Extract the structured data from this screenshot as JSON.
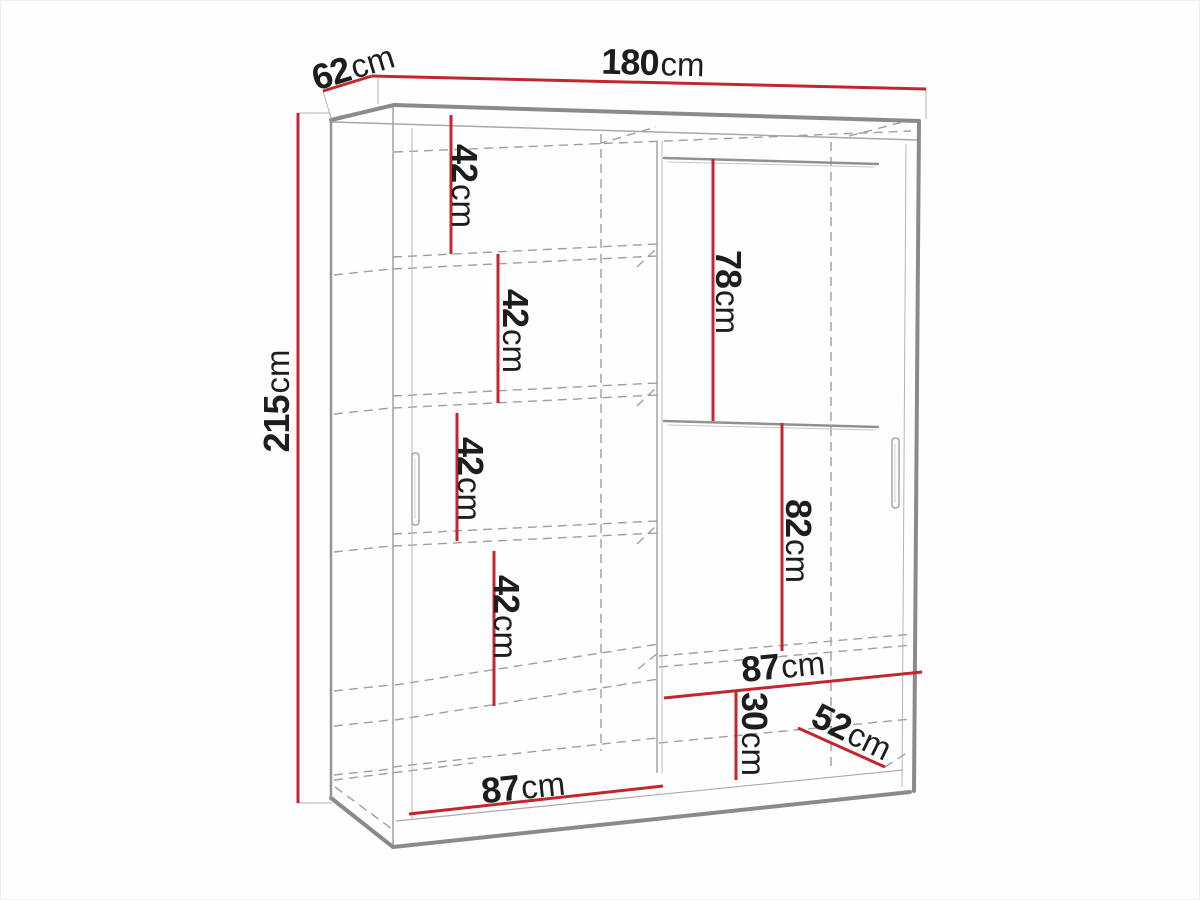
{
  "figure": {
    "subject": "Two-door sliding wardrobe dimension diagram",
    "view": "front perspective line drawing with see-through doors, shelves left, hanging rods right"
  },
  "colors": {
    "dimension_red": "#c2262e",
    "outline_gray": "#8a8a8a",
    "text": "#1d1d1b"
  },
  "dims": {
    "height": {
      "value": "215",
      "unit": "cm"
    },
    "depth": {
      "value": "62",
      "unit": "cm"
    },
    "width": {
      "value": "180",
      "unit": "cm"
    },
    "shelf_gap_1": {
      "value": "42",
      "unit": "cm"
    },
    "shelf_gap_2": {
      "value": "42",
      "unit": "cm"
    },
    "shelf_gap_3": {
      "value": "42",
      "unit": "cm"
    },
    "shelf_gap_4": {
      "value": "42",
      "unit": "cm"
    },
    "rod_gap_upper": {
      "value": "78",
      "unit": "cm"
    },
    "rod_gap_lower": {
      "value": "82",
      "unit": "cm"
    },
    "right_width": {
      "value": "87",
      "unit": "cm"
    },
    "bottom_gap": {
      "value": "30",
      "unit": "cm"
    },
    "bottom_depth": {
      "value": "52",
      "unit": "cm"
    },
    "left_width": {
      "value": "87",
      "unit": "cm"
    }
  }
}
